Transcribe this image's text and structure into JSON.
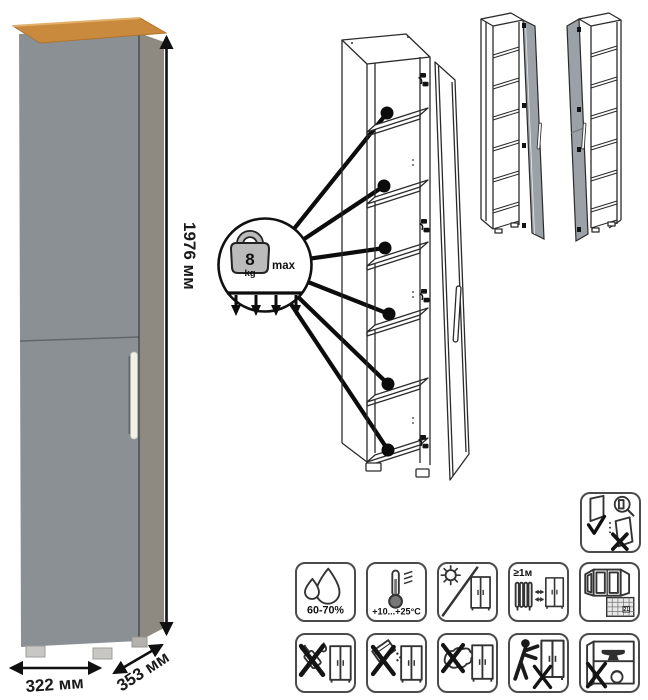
{
  "photo": {
    "height_label": "1976 мм",
    "width_label": "322 мм",
    "depth_label": "353 мм",
    "colors": {
      "door": "#8b9095",
      "side": "#8e8a82",
      "wood": "#c98a3e",
      "wood_edge": "#ad752e",
      "handle": "#f2efe7",
      "feet": "#c8c7c4"
    }
  },
  "callout": {
    "weight_value": "8",
    "weight_unit": "kg",
    "max_label": "max",
    "shelf_pointer_count": 6,
    "load_arrow_count": 4
  },
  "diagram": {
    "mini_door_color": "#9ba1a6",
    "line_color": "#2b2b2b"
  },
  "care": {
    "adjust_icon": "door-adjustment-icon",
    "row1": [
      {
        "icon": "humidity-drops-icon",
        "label": "60-70%"
      },
      {
        "icon": "thermometer-icon",
        "label": "+10...+25°C"
      },
      {
        "icon": "no-direct-sunlight-icon"
      },
      {
        "icon": "heat-distance-icon",
        "label": "≥1м"
      },
      {
        "icon": "ventilate-room-icon",
        "calendar_day": "21"
      }
    ],
    "row2": [
      {
        "icon": "no-solvents-icon"
      },
      {
        "icon": "no-abrasive-powder-icon"
      },
      {
        "icon": "no-wet-cloth-icon"
      },
      {
        "icon": "no-dragging-icon"
      },
      {
        "icon": "no-heavy-objects-icon"
      }
    ]
  }
}
